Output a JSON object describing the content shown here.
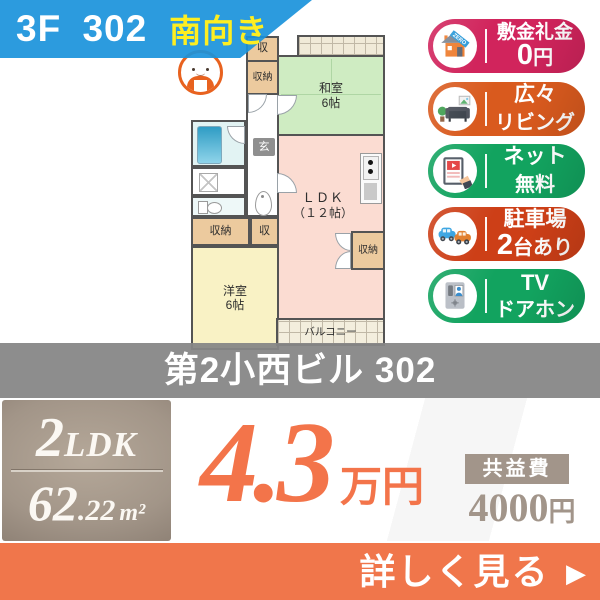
{
  "header": {
    "unit": "3F 302",
    "facing": "南向き"
  },
  "colors": {
    "header_blue": "#1a93db",
    "facing_yellow": "#fdee21",
    "rent_orange": "#f3744a",
    "cta_orange": "#f0764b",
    "taupe": "#a2958a"
  },
  "floorplan": {
    "labels": {
      "washitsu_name": "和室",
      "washitsu_size": "6帖",
      "ldk_name": "ＬＤＫ",
      "ldk_size": "（１２帖）",
      "yoshitsu_name": "洋室",
      "yoshitsu_size": "6帖",
      "genkan": "玄",
      "closet": "収納",
      "closet_short": "収",
      "balcony": "バルコニー"
    }
  },
  "badges": [
    {
      "line1": "敷金礼金",
      "line2_em": "0",
      "line2_rest": "円",
      "color": "#d1245c",
      "icon": "house-zero-icon",
      "ribbon": "ZERO"
    },
    {
      "line1": "広々",
      "line2_em": "",
      "line2_rest": "リビング",
      "color": "#d95a1e",
      "icon": "sofa-icon"
    },
    {
      "line1": "ネット",
      "line2_em": "",
      "line2_rest": "無料",
      "color": "#12a35f",
      "icon": "tablet-icon"
    },
    {
      "line1": "駐車場",
      "line2_em": "2",
      "line2_rest": "台あり",
      "color": "#cd3f17",
      "icon": "cars-icon"
    },
    {
      "line1": "TV",
      "line2_em": "",
      "line2_rest": "ドアホン",
      "color": "#12a35f",
      "icon": "doorphone-icon"
    }
  ],
  "building": {
    "name": "第2小西ビル 302"
  },
  "summary": {
    "layout_num": "2",
    "layout_rest": "LDK",
    "area_int": "62",
    "area_dec": ".22",
    "area_unit": "m²",
    "rent_value": "4.3",
    "rent_unit": "万円",
    "fee_label": "共益費",
    "fee_num": "4000",
    "fee_unit": "円"
  },
  "cta": {
    "label": "詳しく見る",
    "arrow": "▶"
  }
}
